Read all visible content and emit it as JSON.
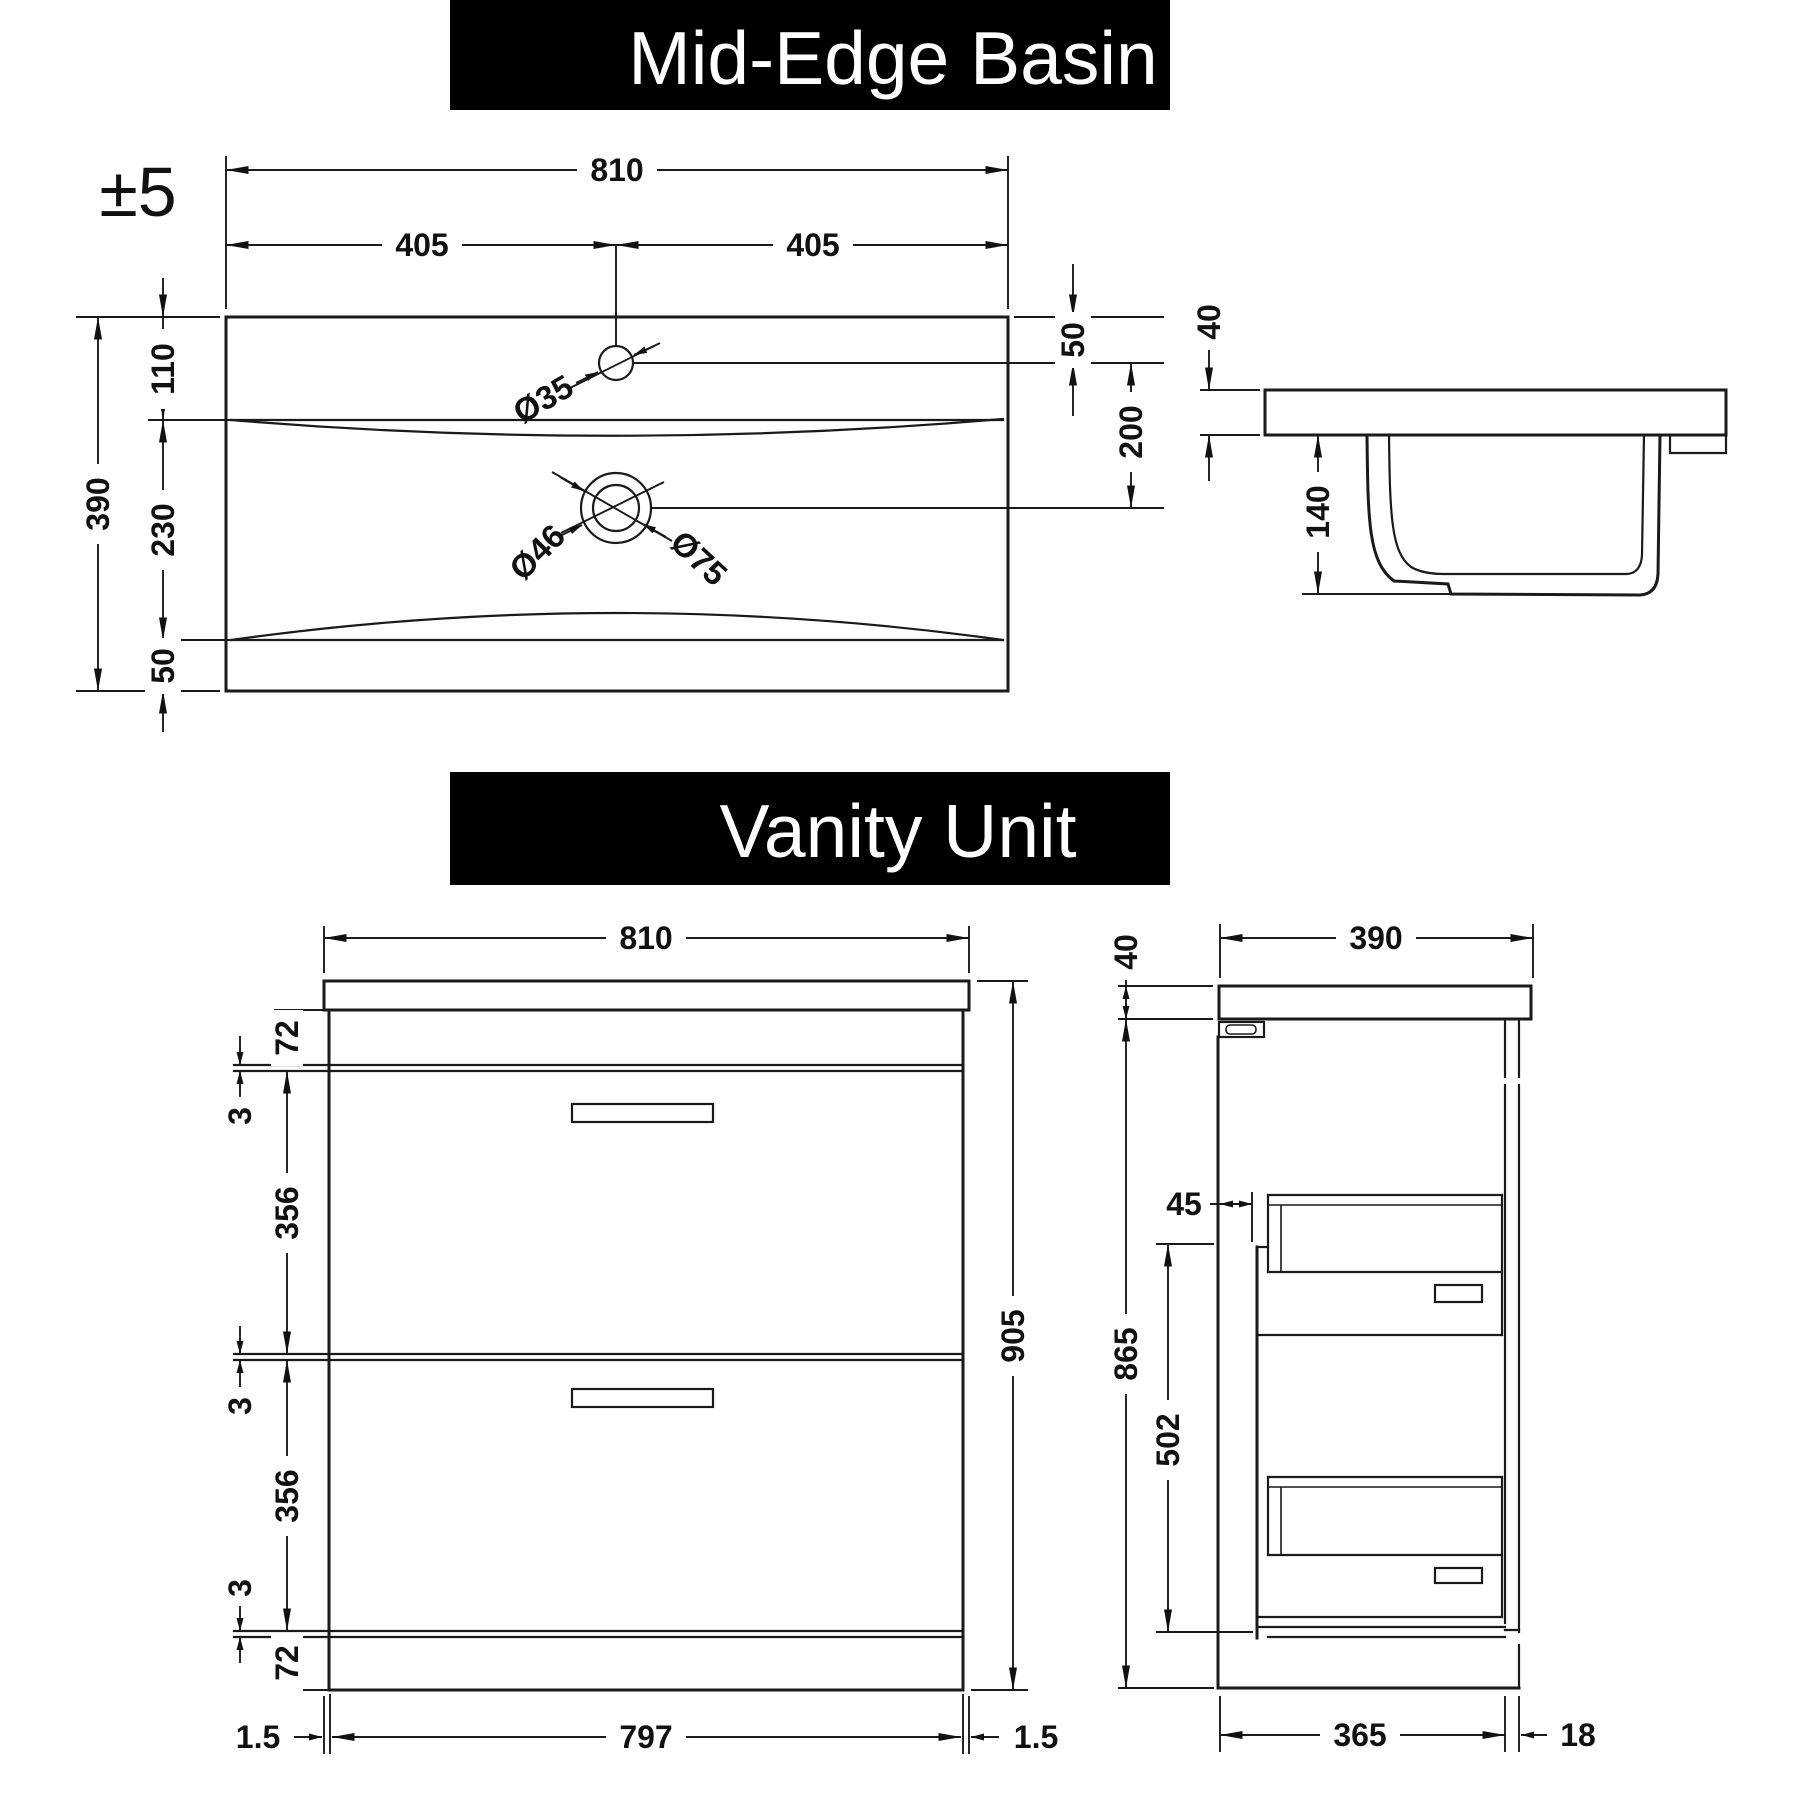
{
  "page": {
    "background": "#ffffff",
    "line_color": "#1a1a1a",
    "banner_bg": "#000000",
    "banner_text_color": "#ffffff"
  },
  "basin": {
    "title": "Mid-Edge Basin",
    "tolerance": "±5",
    "plan": {
      "total_width": "810",
      "half_width_left": "405",
      "half_width_right": "405",
      "total_depth": "390",
      "depth_top": "110",
      "depth_mid": "230",
      "depth_bottom": "50",
      "tap_hole_offset": "50",
      "tap_to_waste": "200",
      "tap_hole_dia": "Ø35",
      "waste_dia_inner": "Ø46",
      "waste_dia_outer": "Ø75"
    },
    "side": {
      "rim_thickness": "40",
      "bowl_depth": "140"
    }
  },
  "vanity": {
    "title": "Vanity Unit",
    "front": {
      "total_width": "810",
      "top_rail": "72",
      "gap_top": "3",
      "upper_drawer": "356",
      "gap_middle": "3",
      "lower_drawer": "356",
      "gap_bottom": "3",
      "bottom_rail": "72",
      "total_height": "905",
      "edge_left": "1.5",
      "carcass_width": "797",
      "edge_right": "1.5"
    },
    "side": {
      "worktop_thickness": "40",
      "total_depth": "390",
      "front_offset": "45",
      "carcass_height": "865",
      "drawer_zone_height": "502",
      "carcass_depth": "365",
      "back_panel": "18"
    }
  }
}
